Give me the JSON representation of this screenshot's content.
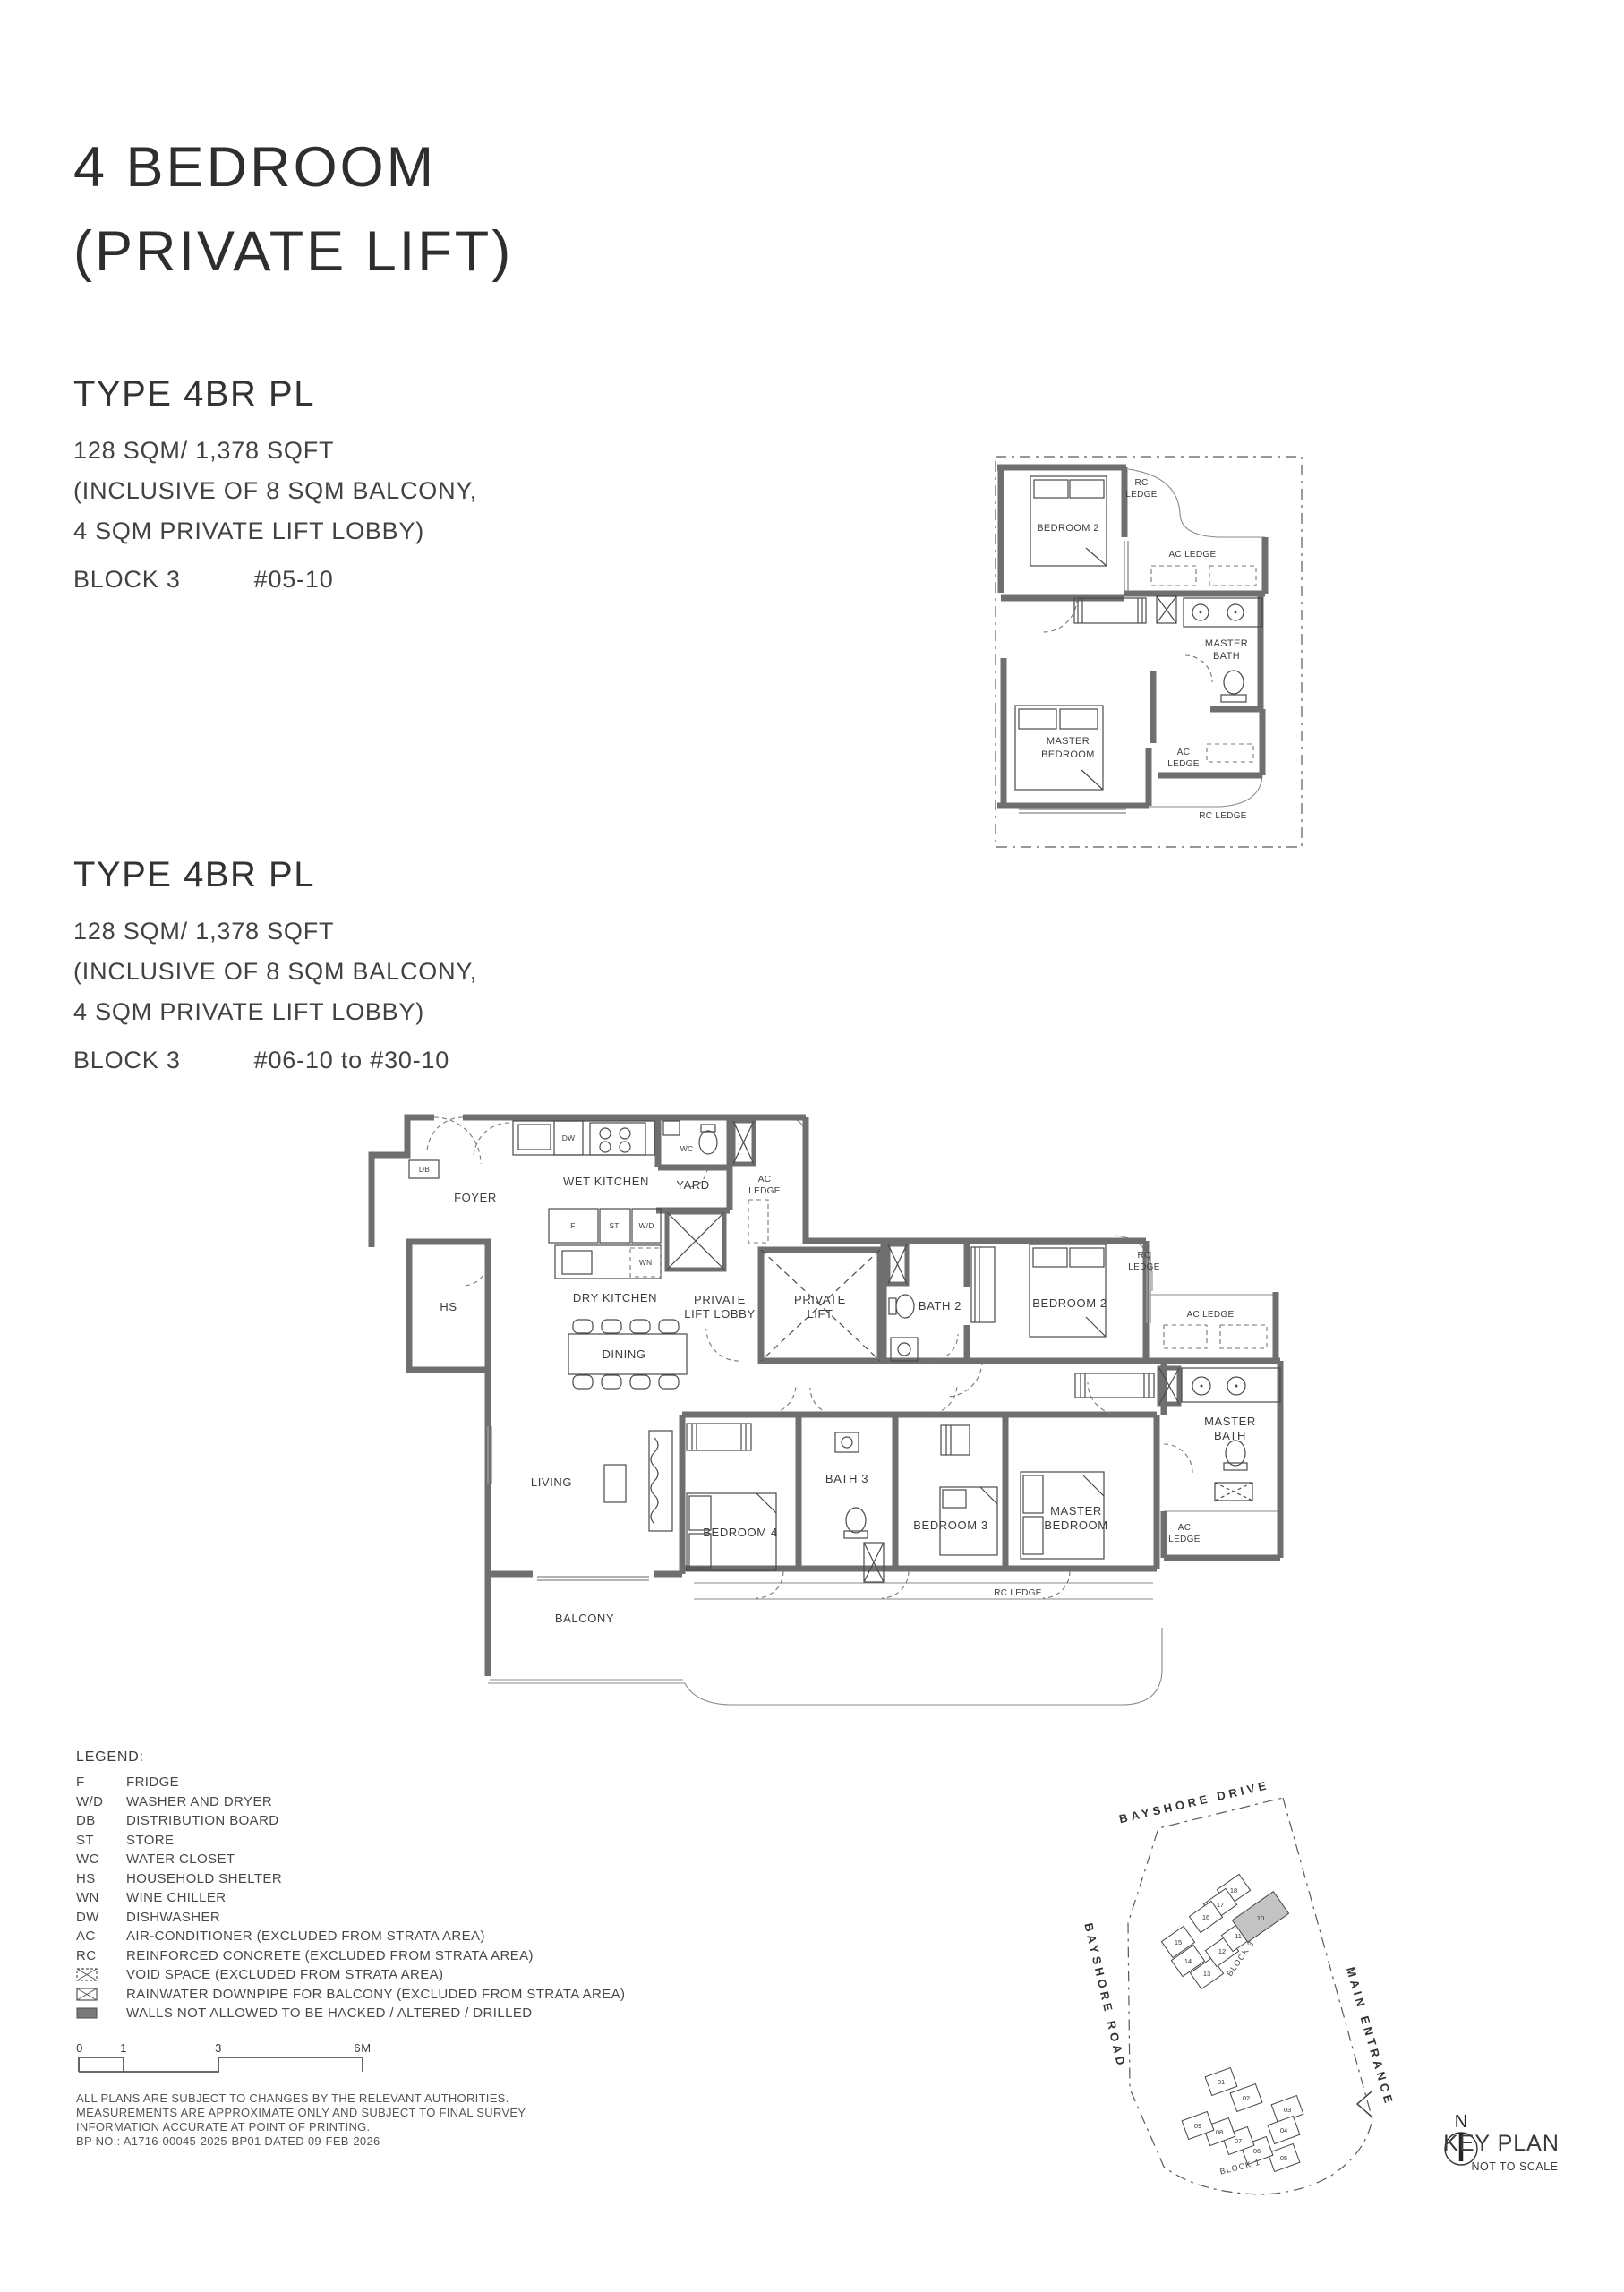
{
  "page": {
    "title_line1": "4 BEDROOM",
    "title_line2": "(PRIVATE LIFT)"
  },
  "type_blocks": [
    {
      "name": "TYPE 4BR PL",
      "area": "128 SQM/ 1,378 SQFT",
      "inclusive_line1": "(INCLUSIVE OF 8 SQM BALCONY,",
      "inclusive_line2": "4 SQM PRIVATE LIFT LOBBY)",
      "block": "BLOCK 3",
      "units": "#05-10"
    },
    {
      "name": "TYPE 4BR PL",
      "area": "128 SQM/ 1,378 SQFT",
      "inclusive_line1": "(INCLUSIVE OF 8 SQM BALCONY,",
      "inclusive_line2": "4 SQM PRIVATE LIFT LOBBY)",
      "block": "BLOCK 3",
      "units": "#06-10 to #30-10"
    }
  ],
  "main_plan": {
    "db": "DB",
    "dw": "DW",
    "wc": "WC",
    "fridge": "F",
    "store": "ST",
    "washer_dryer": "W/D",
    "wine": "WN",
    "foyer": "FOYER",
    "wet_kitchen": "WET KITCHEN",
    "yard": "YARD",
    "hs": "HS",
    "dry_kitchen": "DRY KITCHEN",
    "dining": "DINING",
    "living": "LIVING",
    "balcony": "BALCONY",
    "bedroom4": "BEDROOM 4",
    "bath3": "BATH 3",
    "bedroom3": "BEDROOM 3",
    "bedroom2": "BEDROOM 2",
    "bath2": "BATH 2",
    "private": "PRIVATE",
    "lift_lobby": "LIFT LOBBY",
    "lift": "LIFT",
    "master": "MASTER",
    "bedroom": "BEDROOM",
    "bath": "BATH",
    "ac": "AC",
    "ledge": "LEDGE",
    "ac_ledge": "AC LEDGE",
    "rc": "RC",
    "rc_ledge": "RC LEDGE"
  },
  "small_plan": {
    "bedroom2": "BEDROOM 2",
    "master": "MASTER",
    "bedroom": "BEDROOM",
    "bath": "BATH",
    "ac": "AC",
    "ledge": "LEDGE",
    "ac_ledge": "AC LEDGE",
    "rc": "RC",
    "rc_ledge": "RC LEDGE"
  },
  "legend": {
    "title": "LEGEND:",
    "items": [
      {
        "abbr": "F",
        "label": "FRIDGE"
      },
      {
        "abbr": "W/D",
        "label": "WASHER AND DRYER"
      },
      {
        "abbr": "DB",
        "label": "DISTRIBUTION BOARD"
      },
      {
        "abbr": "ST",
        "label": "STORE"
      },
      {
        "abbr": "WC",
        "label": "WATER CLOSET"
      },
      {
        "abbr": "HS",
        "label": "HOUSEHOLD SHELTER"
      },
      {
        "abbr": "WN",
        "label": "WINE CHILLER"
      },
      {
        "abbr": "DW",
        "label": "DISHWASHER"
      },
      {
        "abbr": "AC",
        "label": "AIR-CONDITIONER (EXCLUDED FROM STRATA AREA)"
      },
      {
        "abbr": "RC",
        "label": "REINFORCED CONCRETE (EXCLUDED FROM STRATA AREA)"
      }
    ],
    "symbol_items": [
      {
        "symbol": "void-space-symbol",
        "label": "VOID SPACE (EXCLUDED FROM STRATA AREA)"
      },
      {
        "symbol": "rainwater-downpipe-symbol",
        "label": "RAINWATER DOWNPIPE FOR BALCONY (EXCLUDED FROM STRATA AREA)"
      },
      {
        "symbol": "hatched-wall-symbol",
        "label": "WALLS NOT ALLOWED TO BE HACKED / ALTERED / DRILLED"
      }
    ]
  },
  "scale_bar": {
    "ticks": [
      "0",
      "1",
      "3",
      "6M"
    ]
  },
  "disclaimer_lines": [
    "ALL PLANS ARE SUBJECT TO CHANGES BY THE RELEVANT AUTHORITIES.",
    "MEASUREMENTS ARE APPROXIMATE ONLY AND SUBJECT TO FINAL SURVEY.",
    "INFORMATION ACCURATE AT POINT OF PRINTING.",
    "BP NO.: A1716-00045-2025-BP01 DATED 09-FEB-2026"
  ],
  "key_plan": {
    "road_top": "BAYSHORE DRIVE",
    "road_left": "BAYSHORE ROAD",
    "road_right": "MAIN ENTRANCE",
    "block3_label": "BLOCK 3",
    "block1_label": "BLOCK 1",
    "block3_units": [
      "18",
      "17",
      "16",
      "15",
      "14",
      "13",
      "12",
      "11"
    ],
    "block1_units": [
      "01",
      "02",
      "03",
      "04",
      "05",
      "06",
      "07",
      "08",
      "09"
    ],
    "highlighted_unit": "10",
    "highlight_color": "#c3c3c3",
    "north_label": "N",
    "title": "KEY PLAN",
    "subtitle": "NOT TO SCALE"
  }
}
